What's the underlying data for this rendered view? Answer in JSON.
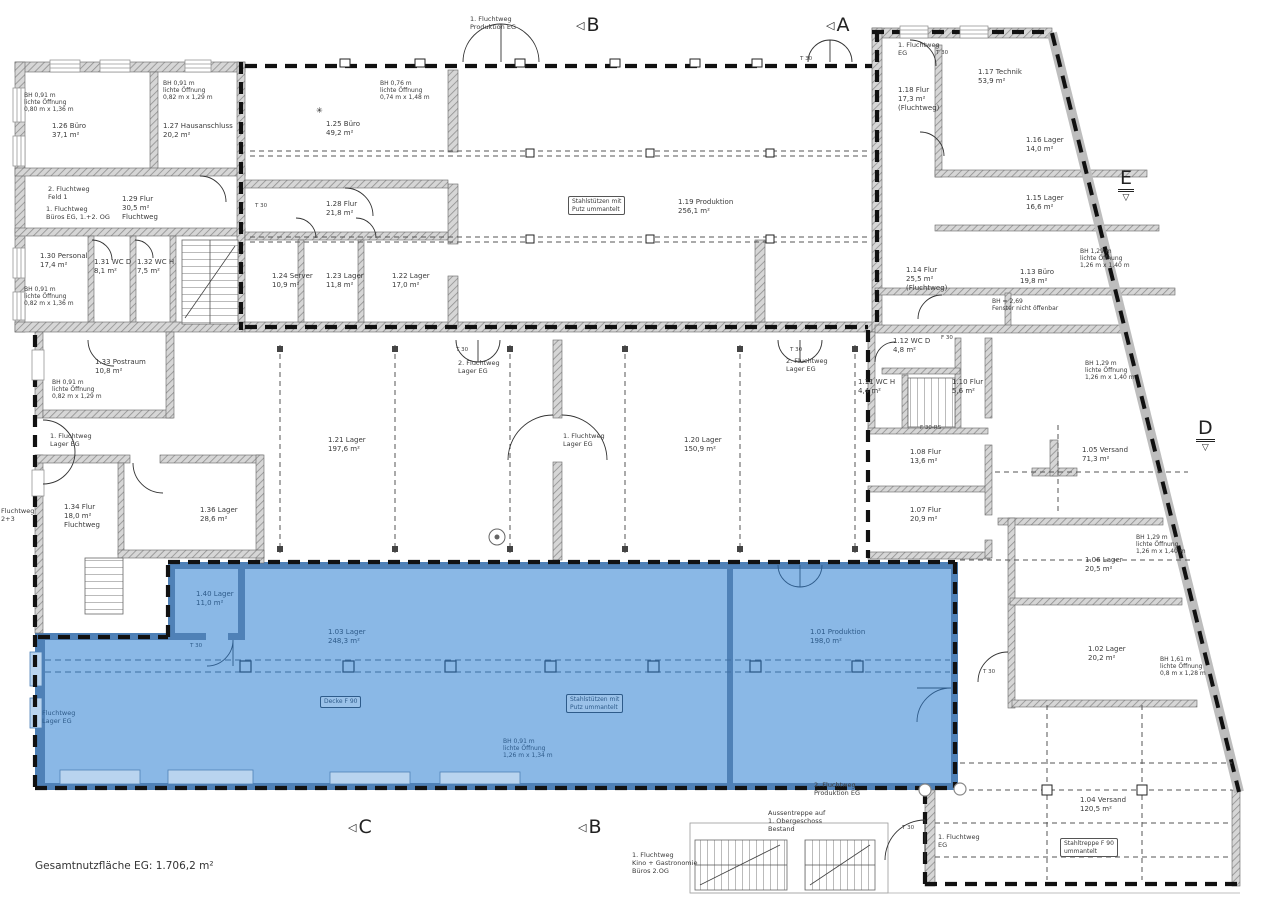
{
  "document": {
    "footer": "Gesamtnutzfläche EG: 1.706,2 m²",
    "type": "Grundriss Erdgeschoss (Bestandsplan mit markierter Fläche)"
  },
  "colors": {
    "highlight_fill": "#8AB8E6",
    "highlight_wall": "#4F81B7",
    "highlight_text": "#2E5B8A",
    "wall_gray": "#D6D6D6",
    "line_black": "#111111"
  },
  "section_markers": [
    {
      "letter": "B",
      "style": "flag",
      "x": 576,
      "y": 14
    },
    {
      "letter": "A",
      "style": "flag",
      "x": 826,
      "y": 14
    },
    {
      "letter": "E",
      "style": "datum",
      "x": 1118,
      "y": 168
    },
    {
      "letter": "D",
      "style": "datum",
      "x": 1196,
      "y": 418
    },
    {
      "letter": "C",
      "style": "flag",
      "x": 348,
      "y": 816
    },
    {
      "letter": "B",
      "style": "flag",
      "x": 578,
      "y": 816
    }
  ],
  "labels": [
    {
      "k": "note",
      "x": 24,
      "y": 92,
      "t": [
        "BH 0,91 m",
        "lichte Öffnung",
        "0,80 m x 1,36 m"
      ]
    },
    {
      "k": "room",
      "x": 52,
      "y": 122,
      "t": [
        "1.26 Büro",
        "37,1 m²"
      ],
      "name": "room-1-26"
    },
    {
      "k": "note",
      "x": 163,
      "y": 80,
      "t": [
        "BH 0,91 m",
        "lichte Öffnung",
        "0,82 m x 1,29 m"
      ]
    },
    {
      "k": "room",
      "x": 163,
      "y": 122,
      "t": [
        "1.27 Hausanschluss",
        "20,2 m²"
      ],
      "name": "room-1-27"
    },
    {
      "k": "flucht",
      "x": 48,
      "y": 186,
      "t": [
        "2. Fluchtweg",
        "Feld 1"
      ]
    },
    {
      "k": "flucht",
      "x": 46,
      "y": 206,
      "t": [
        "1. Fluchtweg",
        "Büros EG, 1.+2. OG"
      ]
    },
    {
      "k": "room",
      "x": 122,
      "y": 195,
      "t": [
        "1.29 Flur",
        "30,5 m²",
        "Fluchtweg"
      ],
      "name": "room-1-29"
    },
    {
      "k": "room",
      "x": 40,
      "y": 252,
      "t": [
        "1.30 Personal",
        "17,4 m²"
      ],
      "name": "room-1-30"
    },
    {
      "k": "note",
      "x": 24,
      "y": 286,
      "t": [
        "BH 0,91 m",
        "lichte Öffnung",
        "0,82 m x 1,36 m"
      ]
    },
    {
      "k": "room",
      "x": 94,
      "y": 258,
      "t": [
        "1.31 WC D",
        "8,1 m²"
      ],
      "name": "room-1-31"
    },
    {
      "k": "room",
      "x": 137,
      "y": 258,
      "t": [
        "1.32 WC H",
        "7,5 m²"
      ],
      "name": "room-1-32"
    },
    {
      "k": "note",
      "x": 380,
      "y": 80,
      "t": [
        "BH 0,76 m",
        "lichte Öffnung",
        "0,74 m x 1,48 m"
      ]
    },
    {
      "k": "symbol",
      "x": 316,
      "y": 106,
      "t": [
        "✳"
      ]
    },
    {
      "k": "room",
      "x": 326,
      "y": 120,
      "t": [
        "1.25 Büro",
        "49,2 m²"
      ],
      "name": "room-1-25"
    },
    {
      "k": "room",
      "x": 326,
      "y": 200,
      "t": [
        "1.28 Flur",
        "21,8 m²"
      ],
      "name": "room-1-28"
    },
    {
      "k": "room",
      "x": 272,
      "y": 272,
      "t": [
        "1.24 Server",
        "10,9 m²"
      ],
      "name": "room-1-24"
    },
    {
      "k": "room",
      "x": 326,
      "y": 272,
      "t": [
        "1.23 Lager",
        "11,8 m²"
      ],
      "name": "room-1-23"
    },
    {
      "k": "room",
      "x": 392,
      "y": 272,
      "t": [
        "1.22 Lager",
        "17,0 m²"
      ],
      "name": "room-1-22"
    },
    {
      "k": "room",
      "x": 678,
      "y": 198,
      "t": [
        "1.19 Produktion",
        "256,1 m²"
      ],
      "name": "room-1-19"
    },
    {
      "k": "boxed",
      "x": 568,
      "y": 196,
      "t": [
        "Stahlstützen mit",
        "Putz ummantelt"
      ]
    },
    {
      "k": "flucht",
      "x": 470,
      "y": 16,
      "t": [
        "1. Fluchtweg",
        "Produktion EG"
      ]
    },
    {
      "k": "door",
      "x": 800,
      "y": 56,
      "t": [
        "T 30"
      ]
    },
    {
      "k": "door",
      "x": 936,
      "y": 50,
      "t": [
        "T 30"
      ]
    },
    {
      "k": "flucht",
      "x": 898,
      "y": 42,
      "t": [
        "1. Fluchtweg",
        "EG"
      ]
    },
    {
      "k": "room",
      "x": 978,
      "y": 68,
      "t": [
        "1.17 Technik",
        "53,9 m²"
      ],
      "name": "room-1-17"
    },
    {
      "k": "room",
      "x": 898,
      "y": 86,
      "t": [
        "1.18 Flur",
        "17,3 m²",
        "(Fluchtweg)"
      ],
      "name": "room-1-18"
    },
    {
      "k": "room",
      "x": 1026,
      "y": 136,
      "t": [
        "1.16 Lager",
        "14,0 m²"
      ],
      "name": "room-1-16"
    },
    {
      "k": "room",
      "x": 1026,
      "y": 194,
      "t": [
        "1.15 Lager",
        "16,6 m²"
      ],
      "name": "room-1-15"
    },
    {
      "k": "room",
      "x": 906,
      "y": 266,
      "t": [
        "1.14 Flur",
        "25,5 m²",
        "(Fluchtweg)"
      ],
      "name": "room-1-14"
    },
    {
      "k": "room",
      "x": 1020,
      "y": 268,
      "t": [
        "1.13 Büro",
        "19,8 m²"
      ],
      "name": "room-1-13"
    },
    {
      "k": "note",
      "x": 1080,
      "y": 248,
      "t": [
        "BH 1,29 m",
        "lichte Öffnung",
        "1,26 m x 1,40 m"
      ]
    },
    {
      "k": "note",
      "x": 992,
      "y": 298,
      "t": [
        "BH = 2,69",
        "Fenster nicht öffenbar"
      ]
    },
    {
      "k": "room",
      "x": 893,
      "y": 337,
      "t": [
        "1.12 WC D",
        "4,8 m²"
      ],
      "name": "room-1-12"
    },
    {
      "k": "door",
      "x": 941,
      "y": 335,
      "t": [
        "F 30"
      ]
    },
    {
      "k": "room",
      "x": 858,
      "y": 378,
      "t": [
        "1.11 WC H",
        "4,4 m²"
      ],
      "name": "room-1-11"
    },
    {
      "k": "room",
      "x": 952,
      "y": 378,
      "t": [
        "1.10 Flur",
        "5,6 m²"
      ],
      "name": "room-1-10"
    },
    {
      "k": "door",
      "x": 920,
      "y": 425,
      "t": [
        "F 30-RS"
      ]
    },
    {
      "k": "room",
      "x": 910,
      "y": 448,
      "t": [
        "1.08 Flur",
        "13,6 m²"
      ],
      "name": "room-1-08"
    },
    {
      "k": "room",
      "x": 910,
      "y": 506,
      "t": [
        "1.07 Flur",
        "20,9 m²"
      ],
      "name": "room-1-07"
    },
    {
      "k": "note",
      "x": 1085,
      "y": 360,
      "t": [
        "BH 1,29 m",
        "lichte Öffnung",
        "1,26 m x 1,40 m"
      ]
    },
    {
      "k": "room",
      "x": 1082,
      "y": 446,
      "t": [
        "1.05 Versand",
        "71,3 m²"
      ],
      "name": "room-1-05"
    },
    {
      "k": "note",
      "x": 1136,
      "y": 534,
      "t": [
        "BH 1,29 m",
        "lichte Öffnung",
        "1,26 m x 1,40 m"
      ]
    },
    {
      "k": "room",
      "x": 1085,
      "y": 556,
      "t": [
        "1.06 Lager",
        "20,5 m²"
      ],
      "name": "room-1-06"
    },
    {
      "k": "room",
      "x": 1088,
      "y": 645,
      "t": [
        "1.02 Lager",
        "20,2 m²"
      ],
      "name": "room-1-02"
    },
    {
      "k": "note",
      "x": 1160,
      "y": 656,
      "t": [
        "BH 1,61 m",
        "lichte Öffnung",
        "0,8 m x 1,28 m"
      ]
    },
    {
      "k": "room",
      "x": 95,
      "y": 358,
      "t": [
        "1.33 Postraum",
        "10,8 m²"
      ],
      "name": "room-1-33"
    },
    {
      "k": "note",
      "x": 52,
      "y": 379,
      "t": [
        "BH 0,91 m",
        "lichte Öffnung",
        "0,82 m x 1,29 m"
      ]
    },
    {
      "k": "flucht",
      "x": 50,
      "y": 433,
      "t": [
        "1. Fluchtweg",
        "Lager EG"
      ]
    },
    {
      "k": "room",
      "x": 64,
      "y": 503,
      "t": [
        "1.34 Flur",
        "18,0 m²",
        "Fluchtweg"
      ],
      "name": "room-1-34"
    },
    {
      "k": "room",
      "x": 200,
      "y": 506,
      "t": [
        "1.36 Lager",
        "28,6 m²"
      ],
      "name": "room-1-36"
    },
    {
      "k": "flucht",
      "x": 1,
      "y": 508,
      "t": [
        "Fluchtweg",
        "2+3"
      ]
    },
    {
      "k": "room",
      "x": 328,
      "y": 436,
      "t": [
        "1.21 Lager",
        "197,6 m²"
      ],
      "name": "room-1-21"
    },
    {
      "k": "room",
      "x": 684,
      "y": 436,
      "t": [
        "1.20 Lager",
        "150,9 m²"
      ],
      "name": "room-1-20"
    },
    {
      "k": "door",
      "x": 456,
      "y": 347,
      "t": [
        "T 30"
      ]
    },
    {
      "k": "flucht",
      "x": 458,
      "y": 360,
      "t": [
        "2. Fluchtweg",
        "Lager EG"
      ]
    },
    {
      "k": "flucht",
      "x": 563,
      "y": 433,
      "t": [
        "1. Fluchtweg",
        "Lager EG"
      ]
    },
    {
      "k": "door",
      "x": 790,
      "y": 347,
      "t": [
        "T 30"
      ]
    },
    {
      "k": "flucht",
      "x": 786,
      "y": 358,
      "t": [
        "2. Fluchtweg",
        "Lager EG"
      ]
    },
    {
      "k": "door",
      "x": 255,
      "y": 203,
      "t": [
        "T 30"
      ]
    },
    {
      "k": "room-blue",
      "x": 196,
      "y": 590,
      "t": [
        "1.40 Lager",
        "11,0 m²"
      ],
      "name": "room-1-40"
    },
    {
      "k": "door-blue",
      "x": 190,
      "y": 643,
      "t": [
        "T 30"
      ]
    },
    {
      "k": "room-blue",
      "x": 328,
      "y": 628,
      "t": [
        "1.03 Lager",
        "248,3 m²"
      ],
      "name": "room-1-03"
    },
    {
      "k": "room-blue",
      "x": 810,
      "y": 628,
      "t": [
        "1.01 Produktion",
        "198,0 m²"
      ],
      "name": "room-1-01"
    },
    {
      "k": "boxed-blue",
      "x": 320,
      "y": 696,
      "t": [
        "Decke F 90"
      ]
    },
    {
      "k": "boxed-blue",
      "x": 566,
      "y": 694,
      "t": [
        "Stahlstützen mit",
        "Putz ummantelt"
      ]
    },
    {
      "k": "note-blue",
      "x": 503,
      "y": 738,
      "t": [
        "BH 0,91 m",
        "lichte Öffnung",
        "1,26 m x 1,34 m"
      ]
    },
    {
      "k": "flucht-blue",
      "x": 42,
      "y": 710,
      "t": [
        "Fluchtweg",
        "Lager EG"
      ]
    },
    {
      "k": "flucht",
      "x": 814,
      "y": 782,
      "t": [
        "2. Fluchtweg",
        "Produktion EG"
      ]
    },
    {
      "k": "flucht",
      "x": 768,
      "y": 810,
      "t": [
        "Aussentreppe auf",
        "1. Obergeschoss",
        "Bestand"
      ]
    },
    {
      "k": "flucht",
      "x": 632,
      "y": 852,
      "t": [
        "1. Fluchtweg",
        "Kino + Gastronomie",
        "Büros 2.OG"
      ]
    },
    {
      "k": "door",
      "x": 902,
      "y": 825,
      "t": [
        "T 30"
      ]
    },
    {
      "k": "flucht",
      "x": 938,
      "y": 834,
      "t": [
        "1. Fluchtweg",
        "EG"
      ]
    },
    {
      "k": "room",
      "x": 1080,
      "y": 796,
      "t": [
        "1.04 Versand",
        "120,5 m²"
      ],
      "name": "room-1-04"
    },
    {
      "k": "boxed",
      "x": 1060,
      "y": 838,
      "t": [
        "Stahltreppe F 90",
        "ummantelt"
      ]
    },
    {
      "k": "door",
      "x": 983,
      "y": 669,
      "t": [
        "T 30"
      ]
    },
    {
      "k": "title",
      "x": 35,
      "y": 860,
      "t": [
        "Gesamtnutzfläche EG: 1.706,2 m²"
      ],
      "name": "total-area-note"
    }
  ]
}
